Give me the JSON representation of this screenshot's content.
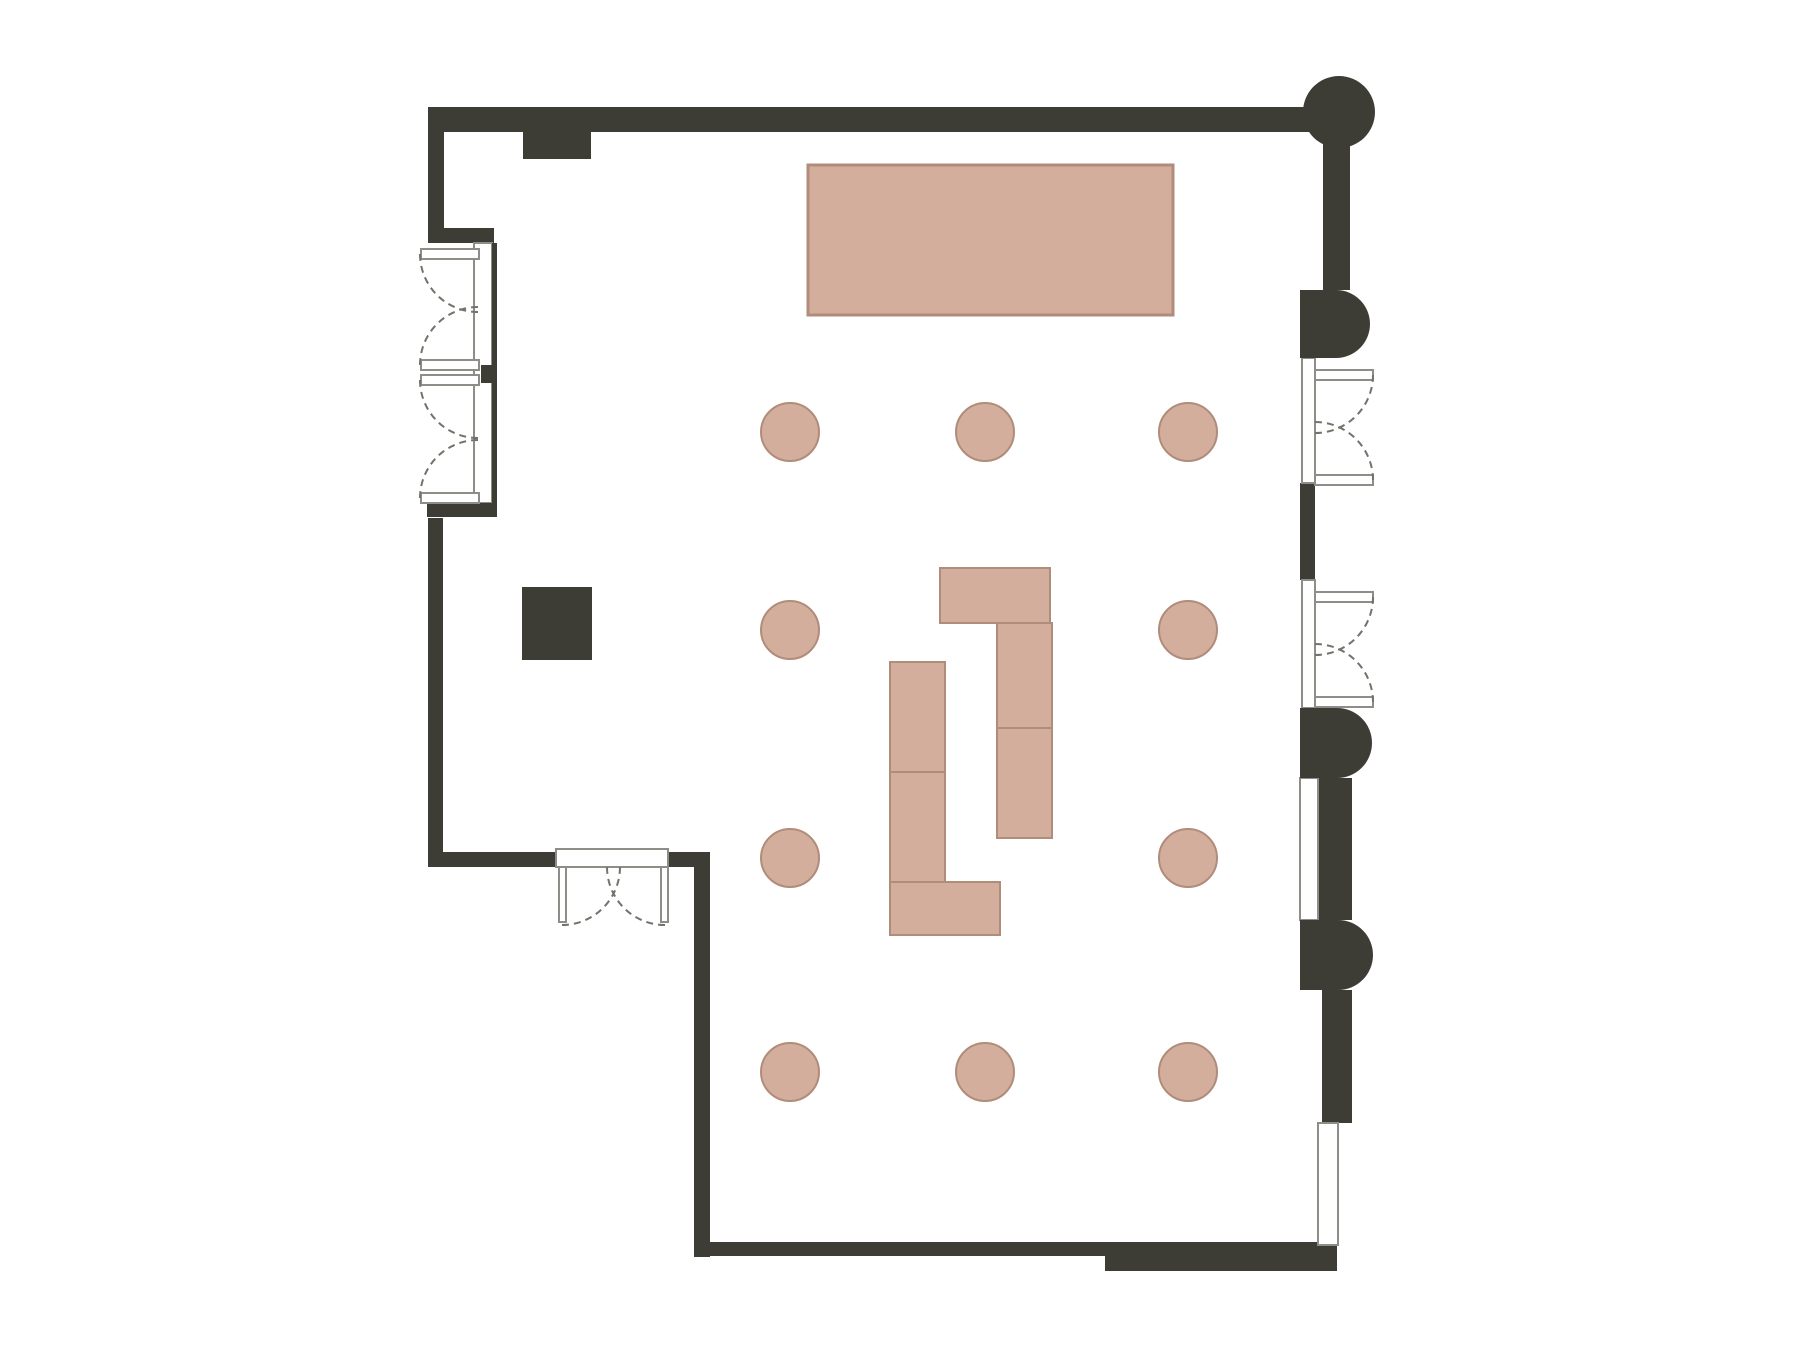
{
  "canvas": {
    "width": 1800,
    "height": 1350,
    "background": "#ffffff"
  },
  "colors": {
    "wall": "#3e3d35",
    "pink": "#d3ae9c",
    "pinkStroke": "#b08c7a",
    "frame": "#8e8e88",
    "arc": "#73736c",
    "white": "#ffffff"
  },
  "plan": {
    "elements": [
      {
        "name": "stage-table",
        "shape": "rect",
        "x": 808,
        "y": 165,
        "w": 365,
        "h": 150,
        "fill": "pink",
        "stroke": "pinkStroke",
        "sw": 3
      },
      {
        "name": "buffet-right-top",
        "shape": "rect",
        "x": 940,
        "y": 568,
        "w": 110,
        "h": 55,
        "fill": "pink",
        "stroke": "pinkStroke",
        "sw": 2
      },
      {
        "name": "buffet-right-vertical",
        "shape": "rect",
        "x": 997,
        "y": 623,
        "w": 55,
        "h": 215,
        "fill": "pink",
        "stroke": "pinkStroke",
        "sw": 2
      },
      {
        "name": "buffet-right-divider",
        "shape": "line",
        "x1": 997,
        "y1": 728,
        "x2": 1052,
        "y2": 728,
        "stroke": "pinkStroke",
        "sw": 2
      },
      {
        "name": "buffet-left-vertical",
        "shape": "rect",
        "x": 890,
        "y": 662,
        "w": 55,
        "h": 220,
        "fill": "pink",
        "stroke": "pinkStroke",
        "sw": 2
      },
      {
        "name": "buffet-left-divider",
        "shape": "line",
        "x1": 890,
        "y1": 772,
        "x2": 945,
        "y2": 772,
        "stroke": "pinkStroke",
        "sw": 2
      },
      {
        "name": "buffet-left-bottom",
        "shape": "rect",
        "x": 890,
        "y": 882,
        "w": 110,
        "h": 53,
        "fill": "pink",
        "stroke": "pinkStroke",
        "sw": 2
      },
      {
        "name": "table-1",
        "shape": "circle",
        "cx": 790,
        "cy": 432,
        "r": 29,
        "fill": "pink",
        "stroke": "pinkStroke",
        "sw": 2
      },
      {
        "name": "table-2",
        "shape": "circle",
        "cx": 985,
        "cy": 432,
        "r": 29,
        "fill": "pink",
        "stroke": "pinkStroke",
        "sw": 2
      },
      {
        "name": "table-3",
        "shape": "circle",
        "cx": 1188,
        "cy": 432,
        "r": 29,
        "fill": "pink",
        "stroke": "pinkStroke",
        "sw": 2
      },
      {
        "name": "table-4",
        "shape": "circle",
        "cx": 790,
        "cy": 630,
        "r": 29,
        "fill": "pink",
        "stroke": "pinkStroke",
        "sw": 2
      },
      {
        "name": "table-5",
        "shape": "circle",
        "cx": 1188,
        "cy": 630,
        "r": 29,
        "fill": "pink",
        "stroke": "pinkStroke",
        "sw": 2
      },
      {
        "name": "table-6",
        "shape": "circle",
        "cx": 790,
        "cy": 858,
        "r": 29,
        "fill": "pink",
        "stroke": "pinkStroke",
        "sw": 2
      },
      {
        "name": "table-7",
        "shape": "circle",
        "cx": 1188,
        "cy": 858,
        "r": 29,
        "fill": "pink",
        "stroke": "pinkStroke",
        "sw": 2
      },
      {
        "name": "table-8",
        "shape": "circle",
        "cx": 790,
        "cy": 1072,
        "r": 29,
        "fill": "pink",
        "stroke": "pinkStroke",
        "sw": 2
      },
      {
        "name": "table-9",
        "shape": "circle",
        "cx": 985,
        "cy": 1072,
        "r": 29,
        "fill": "pink",
        "stroke": "pinkStroke",
        "sw": 2
      },
      {
        "name": "table-10",
        "shape": "circle",
        "cx": 1188,
        "cy": 1072,
        "r": 29,
        "fill": "pink",
        "stroke": "pinkStroke",
        "sw": 2
      },
      {
        "name": "wall-top",
        "shape": "rect",
        "x": 428,
        "y": 107,
        "w": 916,
        "h": 25,
        "fill": "wall"
      },
      {
        "name": "wall-left-upper",
        "shape": "rect",
        "x": 428,
        "y": 107,
        "w": 16,
        "h": 136,
        "fill": "wall"
      },
      {
        "name": "wall-left-corner",
        "shape": "rect",
        "x": 428,
        "y": 228,
        "w": 66,
        "h": 15,
        "fill": "wall"
      },
      {
        "name": "wall-top-notch",
        "shape": "rect",
        "x": 523,
        "y": 132,
        "w": 68,
        "h": 27,
        "fill": "wall"
      },
      {
        "name": "wall-left",
        "shape": "rect",
        "x": 428,
        "y": 518,
        "w": 15,
        "h": 349,
        "fill": "wall"
      },
      {
        "name": "wall-bottom-left-horizontal",
        "shape": "rect",
        "x": 428,
        "y": 852,
        "w": 132,
        "h": 15,
        "fill": "wall"
      },
      {
        "name": "wall-right-of-bottom-door",
        "shape": "rect",
        "x": 666,
        "y": 852,
        "w": 44,
        "h": 15,
        "fill": "wall"
      },
      {
        "name": "wall-lower-left-vertical",
        "shape": "rect",
        "x": 694,
        "y": 860,
        "w": 16,
        "h": 397,
        "fill": "wall"
      },
      {
        "name": "wall-bottom",
        "shape": "rect",
        "x": 694,
        "y": 1242,
        "w": 643,
        "h": 14,
        "fill": "wall"
      },
      {
        "name": "wall-bottom-right-block",
        "shape": "rect",
        "x": 1105,
        "y": 1256,
        "w": 232,
        "h": 15,
        "fill": "wall"
      },
      {
        "name": "wall-right-upper",
        "shape": "rect",
        "x": 1323,
        "y": 130,
        "w": 27,
        "h": 160,
        "fill": "wall"
      },
      {
        "name": "wall-right-mullion",
        "shape": "rect",
        "x": 1300,
        "y": 483,
        "w": 15,
        "h": 97,
        "fill": "wall"
      },
      {
        "name": "wall-right-mid",
        "shape": "rect",
        "x": 1318,
        "y": 778,
        "w": 34,
        "h": 142,
        "fill": "wall"
      },
      {
        "name": "wall-right-low",
        "shape": "rect",
        "x": 1322,
        "y": 990,
        "w": 30,
        "h": 133,
        "fill": "wall"
      },
      {
        "name": "frame-left-doors",
        "shape": "rect",
        "x": 474,
        "y": 243,
        "w": 18,
        "h": 260,
        "fill": "white",
        "stroke": "frame",
        "sw": 2
      },
      {
        "name": "frame-bottom-door",
        "shape": "rect",
        "x": 556,
        "y": 849,
        "w": 112,
        "h": 18,
        "fill": "white",
        "stroke": "frame",
        "sw": 2
      },
      {
        "name": "frame-right-door-1",
        "shape": "rect",
        "x": 1302,
        "y": 358,
        "w": 13,
        "h": 125,
        "fill": "white",
        "stroke": "frame",
        "sw": 2
      },
      {
        "name": "frame-right-door-2",
        "shape": "rect",
        "x": 1302,
        "y": 580,
        "w": 13,
        "h": 128,
        "fill": "white",
        "stroke": "frame",
        "sw": 2
      },
      {
        "name": "window-right-mid",
        "shape": "rect",
        "x": 1300,
        "y": 778,
        "w": 18,
        "h": 142,
        "fill": "white",
        "stroke": "frame",
        "sw": 2
      },
      {
        "name": "window-bottom-right",
        "shape": "rect",
        "x": 1318,
        "y": 1123,
        "w": 20,
        "h": 122,
        "fill": "white",
        "stroke": "frame",
        "sw": 2
      },
      {
        "name": "wall-left-inner-face",
        "shape": "rect",
        "x": 492,
        "y": 243,
        "w": 5,
        "h": 260,
        "fill": "wall"
      },
      {
        "name": "wall-left-door-mullion",
        "shape": "rect",
        "x": 481,
        "y": 365,
        "w": 15,
        "h": 18,
        "fill": "wall"
      },
      {
        "name": "wall-left-bottom-band",
        "shape": "rect",
        "x": 427,
        "y": 503,
        "w": 70,
        "h": 14,
        "fill": "wall"
      },
      {
        "name": "door-leaf-left-a-top",
        "shape": "rect",
        "x": 421,
        "y": 249,
        "w": 58,
        "h": 10,
        "fill": "white",
        "stroke": "frame",
        "sw": 2
      },
      {
        "name": "door-leaf-left-a-bottom",
        "shape": "rect",
        "x": 421,
        "y": 360,
        "w": 58,
        "h": 10,
        "fill": "white",
        "stroke": "frame",
        "sw": 2
      },
      {
        "name": "door-leaf-left-b-top",
        "shape": "rect",
        "x": 421,
        "y": 375,
        "w": 58,
        "h": 10,
        "fill": "white",
        "stroke": "frame",
        "sw": 2
      },
      {
        "name": "door-leaf-left-b-bottom",
        "shape": "rect",
        "x": 421,
        "y": 493,
        "w": 58,
        "h": 10,
        "fill": "white",
        "stroke": "frame",
        "sw": 2
      },
      {
        "name": "door-leaf-bottom-left",
        "shape": "rect",
        "x": 559,
        "y": 867,
        "w": 7,
        "h": 55,
        "fill": "white",
        "stroke": "frame",
        "sw": 2
      },
      {
        "name": "door-leaf-bottom-right",
        "shape": "rect",
        "x": 661,
        "y": 867,
        "w": 7,
        "h": 55,
        "fill": "white",
        "stroke": "frame",
        "sw": 2
      },
      {
        "name": "door-leaf-right-1-top",
        "shape": "rect",
        "x": 1315,
        "y": 370,
        "w": 58,
        "h": 10,
        "fill": "white",
        "stroke": "frame",
        "sw": 2
      },
      {
        "name": "door-leaf-right-1-bottom",
        "shape": "rect",
        "x": 1315,
        "y": 475,
        "w": 58,
        "h": 10,
        "fill": "white",
        "stroke": "frame",
        "sw": 2
      },
      {
        "name": "door-leaf-right-2-top",
        "shape": "rect",
        "x": 1315,
        "y": 592,
        "w": 58,
        "h": 10,
        "fill": "white",
        "stroke": "frame",
        "sw": 2
      },
      {
        "name": "door-leaf-right-2-bottom",
        "shape": "rect",
        "x": 1315,
        "y": 697,
        "w": 58,
        "h": 10,
        "fill": "white",
        "stroke": "frame",
        "sw": 2
      },
      {
        "name": "door-swing-left-a-top",
        "shape": "path",
        "d": "M420,254 A58,58 0 0 0 478,312",
        "stroke": "arc",
        "sw": 2,
        "dash": "7 5"
      },
      {
        "name": "door-swing-left-a-bottom",
        "shape": "path",
        "d": "M420,365 A58,58 0 0 1 478,307",
        "stroke": "arc",
        "sw": 2,
        "dash": "7 5"
      },
      {
        "name": "door-swing-left-b-top",
        "shape": "path",
        "d": "M420,380 A58,58 0 0 0 478,438",
        "stroke": "arc",
        "sw": 2,
        "dash": "7 5"
      },
      {
        "name": "door-swing-left-b-bottom",
        "shape": "path",
        "d": "M420,498 A58,58 0 0 1 478,440",
        "stroke": "arc",
        "sw": 2,
        "dash": "7 5"
      },
      {
        "name": "door-swing-bottom-left",
        "shape": "path",
        "d": "M562,925 A58,58 0 0 0 620,867",
        "stroke": "arc",
        "sw": 2,
        "dash": "7 5"
      },
      {
        "name": "door-swing-bottom-right",
        "shape": "path",
        "d": "M665,925 A58,58 0 0 1 607,867",
        "stroke": "arc",
        "sw": 2,
        "dash": "7 5"
      },
      {
        "name": "door-swing-right-1-top",
        "shape": "path",
        "d": "M1373,375 A58,58 0 0 1 1315,433",
        "stroke": "arc",
        "sw": 2,
        "dash": "7 5"
      },
      {
        "name": "door-swing-right-1-bottom",
        "shape": "path",
        "d": "M1373,480 A58,58 0 0 0 1315,422",
        "stroke": "arc",
        "sw": 2,
        "dash": "7 5"
      },
      {
        "name": "door-swing-right-2-top",
        "shape": "path",
        "d": "M1373,597 A58,58 0 0 1 1315,655",
        "stroke": "arc",
        "sw": 2,
        "dash": "7 5"
      },
      {
        "name": "door-swing-right-2-bottom",
        "shape": "path",
        "d": "M1373,702 A58,58 0 0 0 1315,644",
        "stroke": "arc",
        "sw": 2,
        "dash": "7 5"
      },
      {
        "name": "column-corner-round",
        "shape": "circle",
        "cx": 1339,
        "cy": 112,
        "r": 36,
        "fill": "wall"
      },
      {
        "name": "column-right-1",
        "shape": "path",
        "d": "M1300,290 L1336,290 A34,34 0 0 1 1336,358 L1300,358 Z",
        "fill": "wall"
      },
      {
        "name": "column-right-2",
        "shape": "path",
        "d": "M1300,708 L1337,708 A35,35 0 0 1 1337,778 L1300,778 Z",
        "fill": "wall"
      },
      {
        "name": "column-right-3",
        "shape": "path",
        "d": "M1300,920 L1338,920 A35,35 0 0 1 1338,990 L1300,990 Z",
        "fill": "wall"
      },
      {
        "name": "equipment-square",
        "shape": "rect",
        "x": 522,
        "y": 587,
        "w": 70,
        "h": 73,
        "fill": "wall"
      }
    ]
  }
}
